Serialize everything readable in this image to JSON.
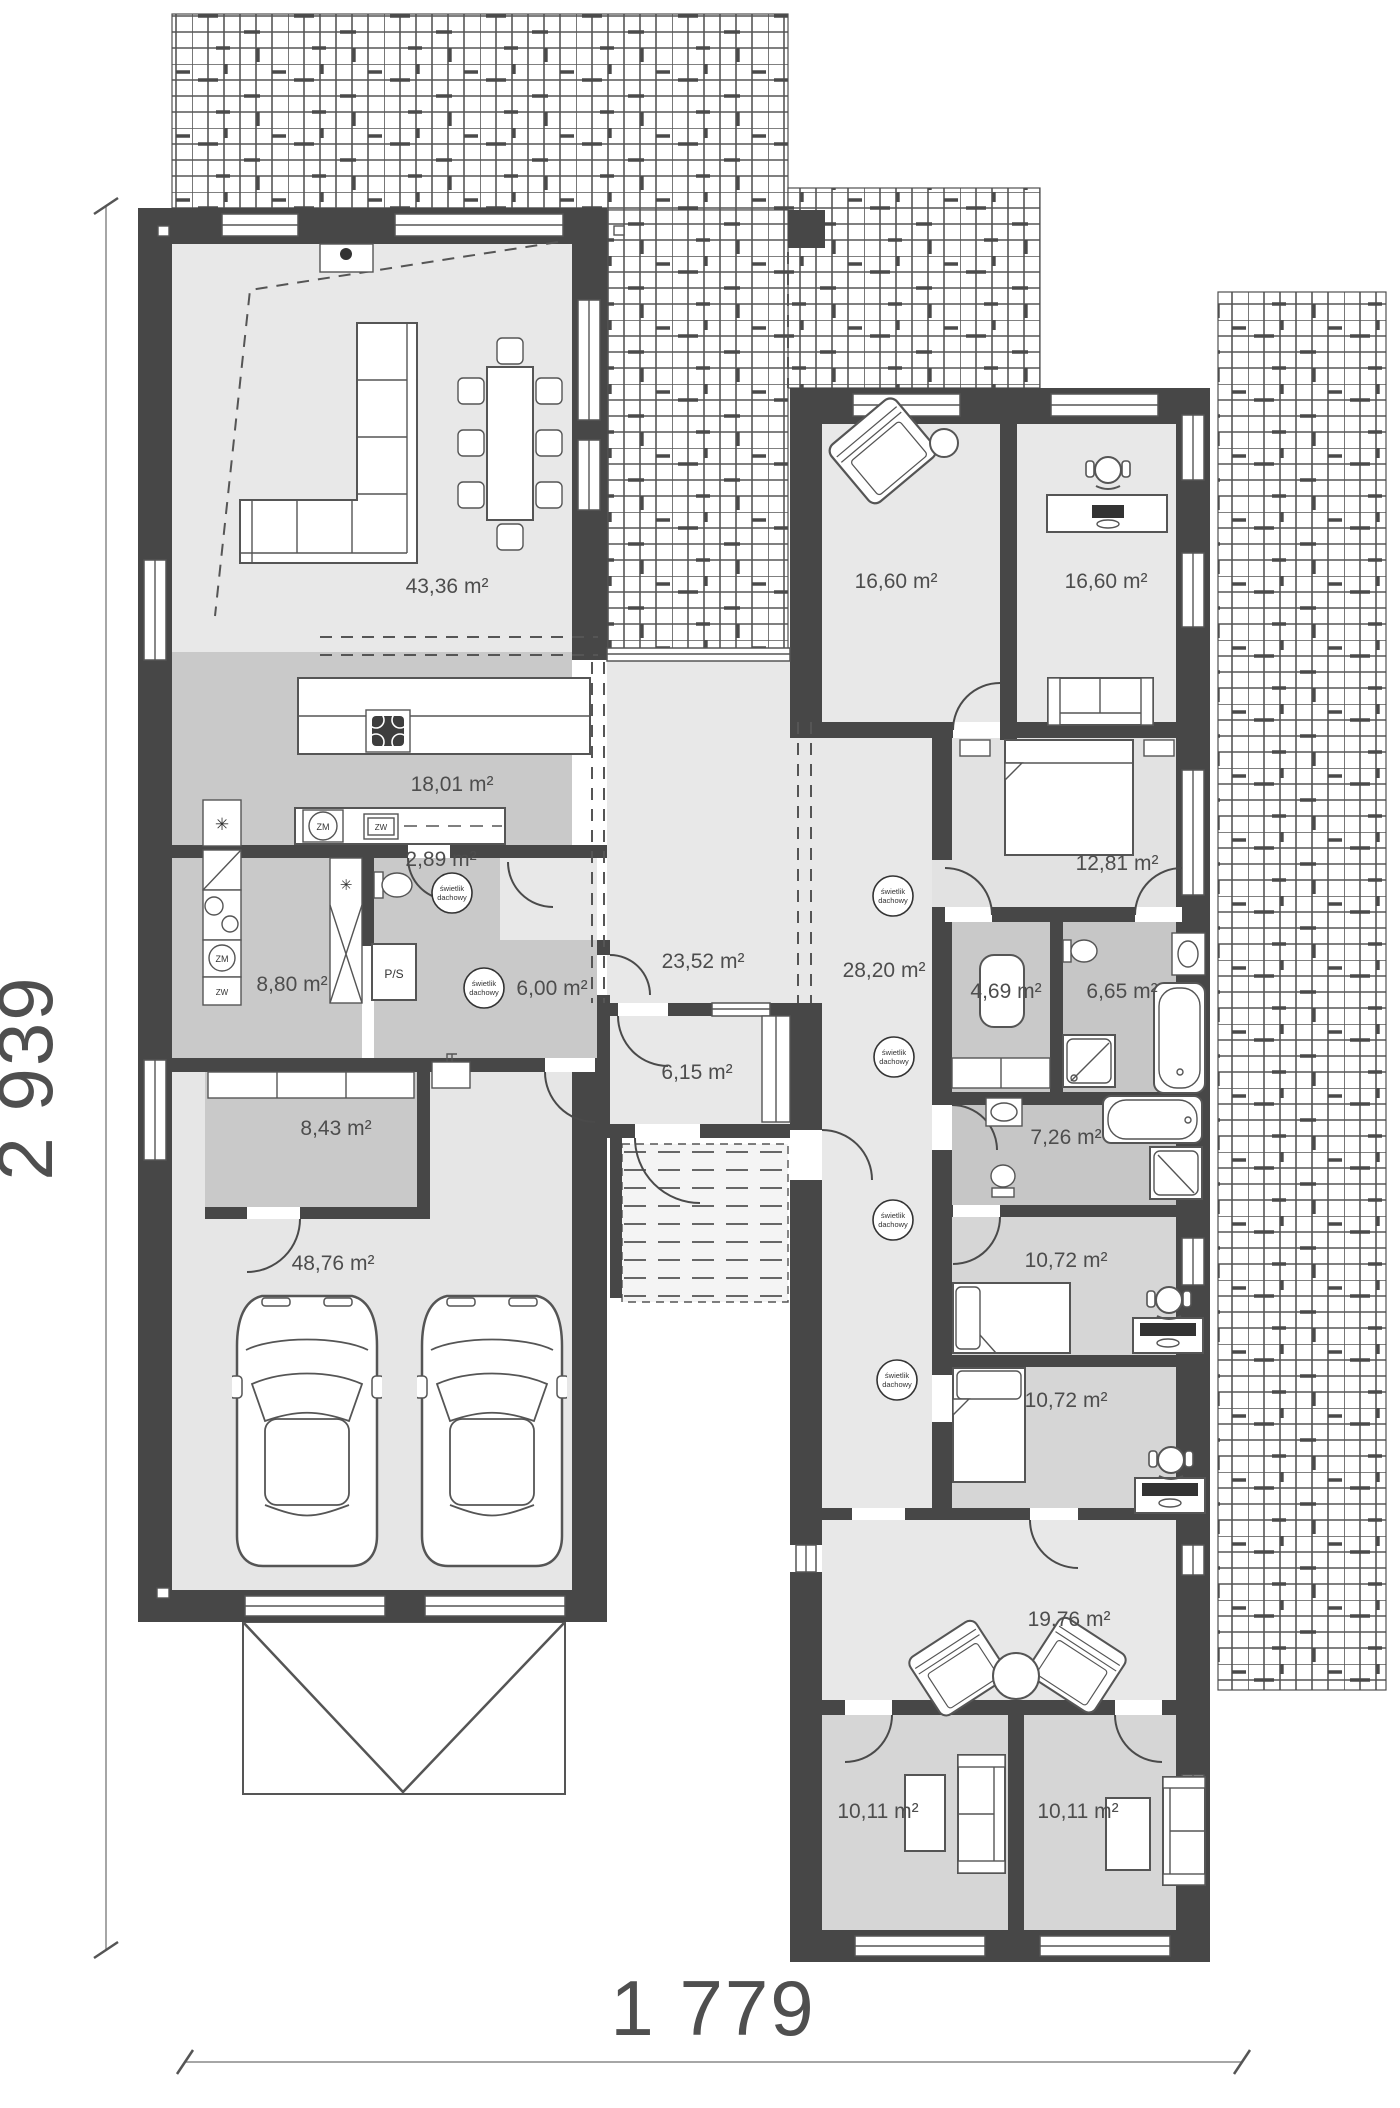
{
  "plan": {
    "dimensions": {
      "height": "2 939",
      "width": "1 779"
    },
    "skylight": {
      "line1": "świetlik",
      "line2": "dachowy"
    },
    "labels": {
      "zm": "ZM",
      "zw": "ZW",
      "ps": "P/S"
    },
    "rooms": [
      {
        "name": "living-dining",
        "area": "43,36 m²"
      },
      {
        "name": "kitchen",
        "area": "18,01 m²"
      },
      {
        "name": "wc",
        "area": "2,89 m²"
      },
      {
        "name": "pantry",
        "area": "8,80 m²"
      },
      {
        "name": "mudroom",
        "area": "6,00 m²"
      },
      {
        "name": "storage",
        "area": "8,43 m²"
      },
      {
        "name": "garage",
        "area": "48,76 m²"
      },
      {
        "name": "hall",
        "area": "23,52 m²"
      },
      {
        "name": "vestibule",
        "area": "6,15 m²"
      },
      {
        "name": "corridor",
        "area": "28,20 m²"
      },
      {
        "name": "room-west",
        "area": "16,60 m²"
      },
      {
        "name": "office",
        "area": "16,60 m²"
      },
      {
        "name": "bedroom",
        "area": "12,81 m²"
      },
      {
        "name": "wardrobe",
        "area": "4,69 m²"
      },
      {
        "name": "bathroom-1",
        "area": "6,65 m²"
      },
      {
        "name": "bathroom-2",
        "area": "7,26 m²"
      },
      {
        "name": "kids-room-1",
        "area": "10,72 m²"
      },
      {
        "name": "kids-room-2",
        "area": "10,72 m²"
      },
      {
        "name": "family-room",
        "area": "19,76 m²"
      },
      {
        "name": "guest-room-1",
        "area": "10,11 m²"
      },
      {
        "name": "guest-room-2",
        "area": "10,11 m²"
      }
    ]
  }
}
